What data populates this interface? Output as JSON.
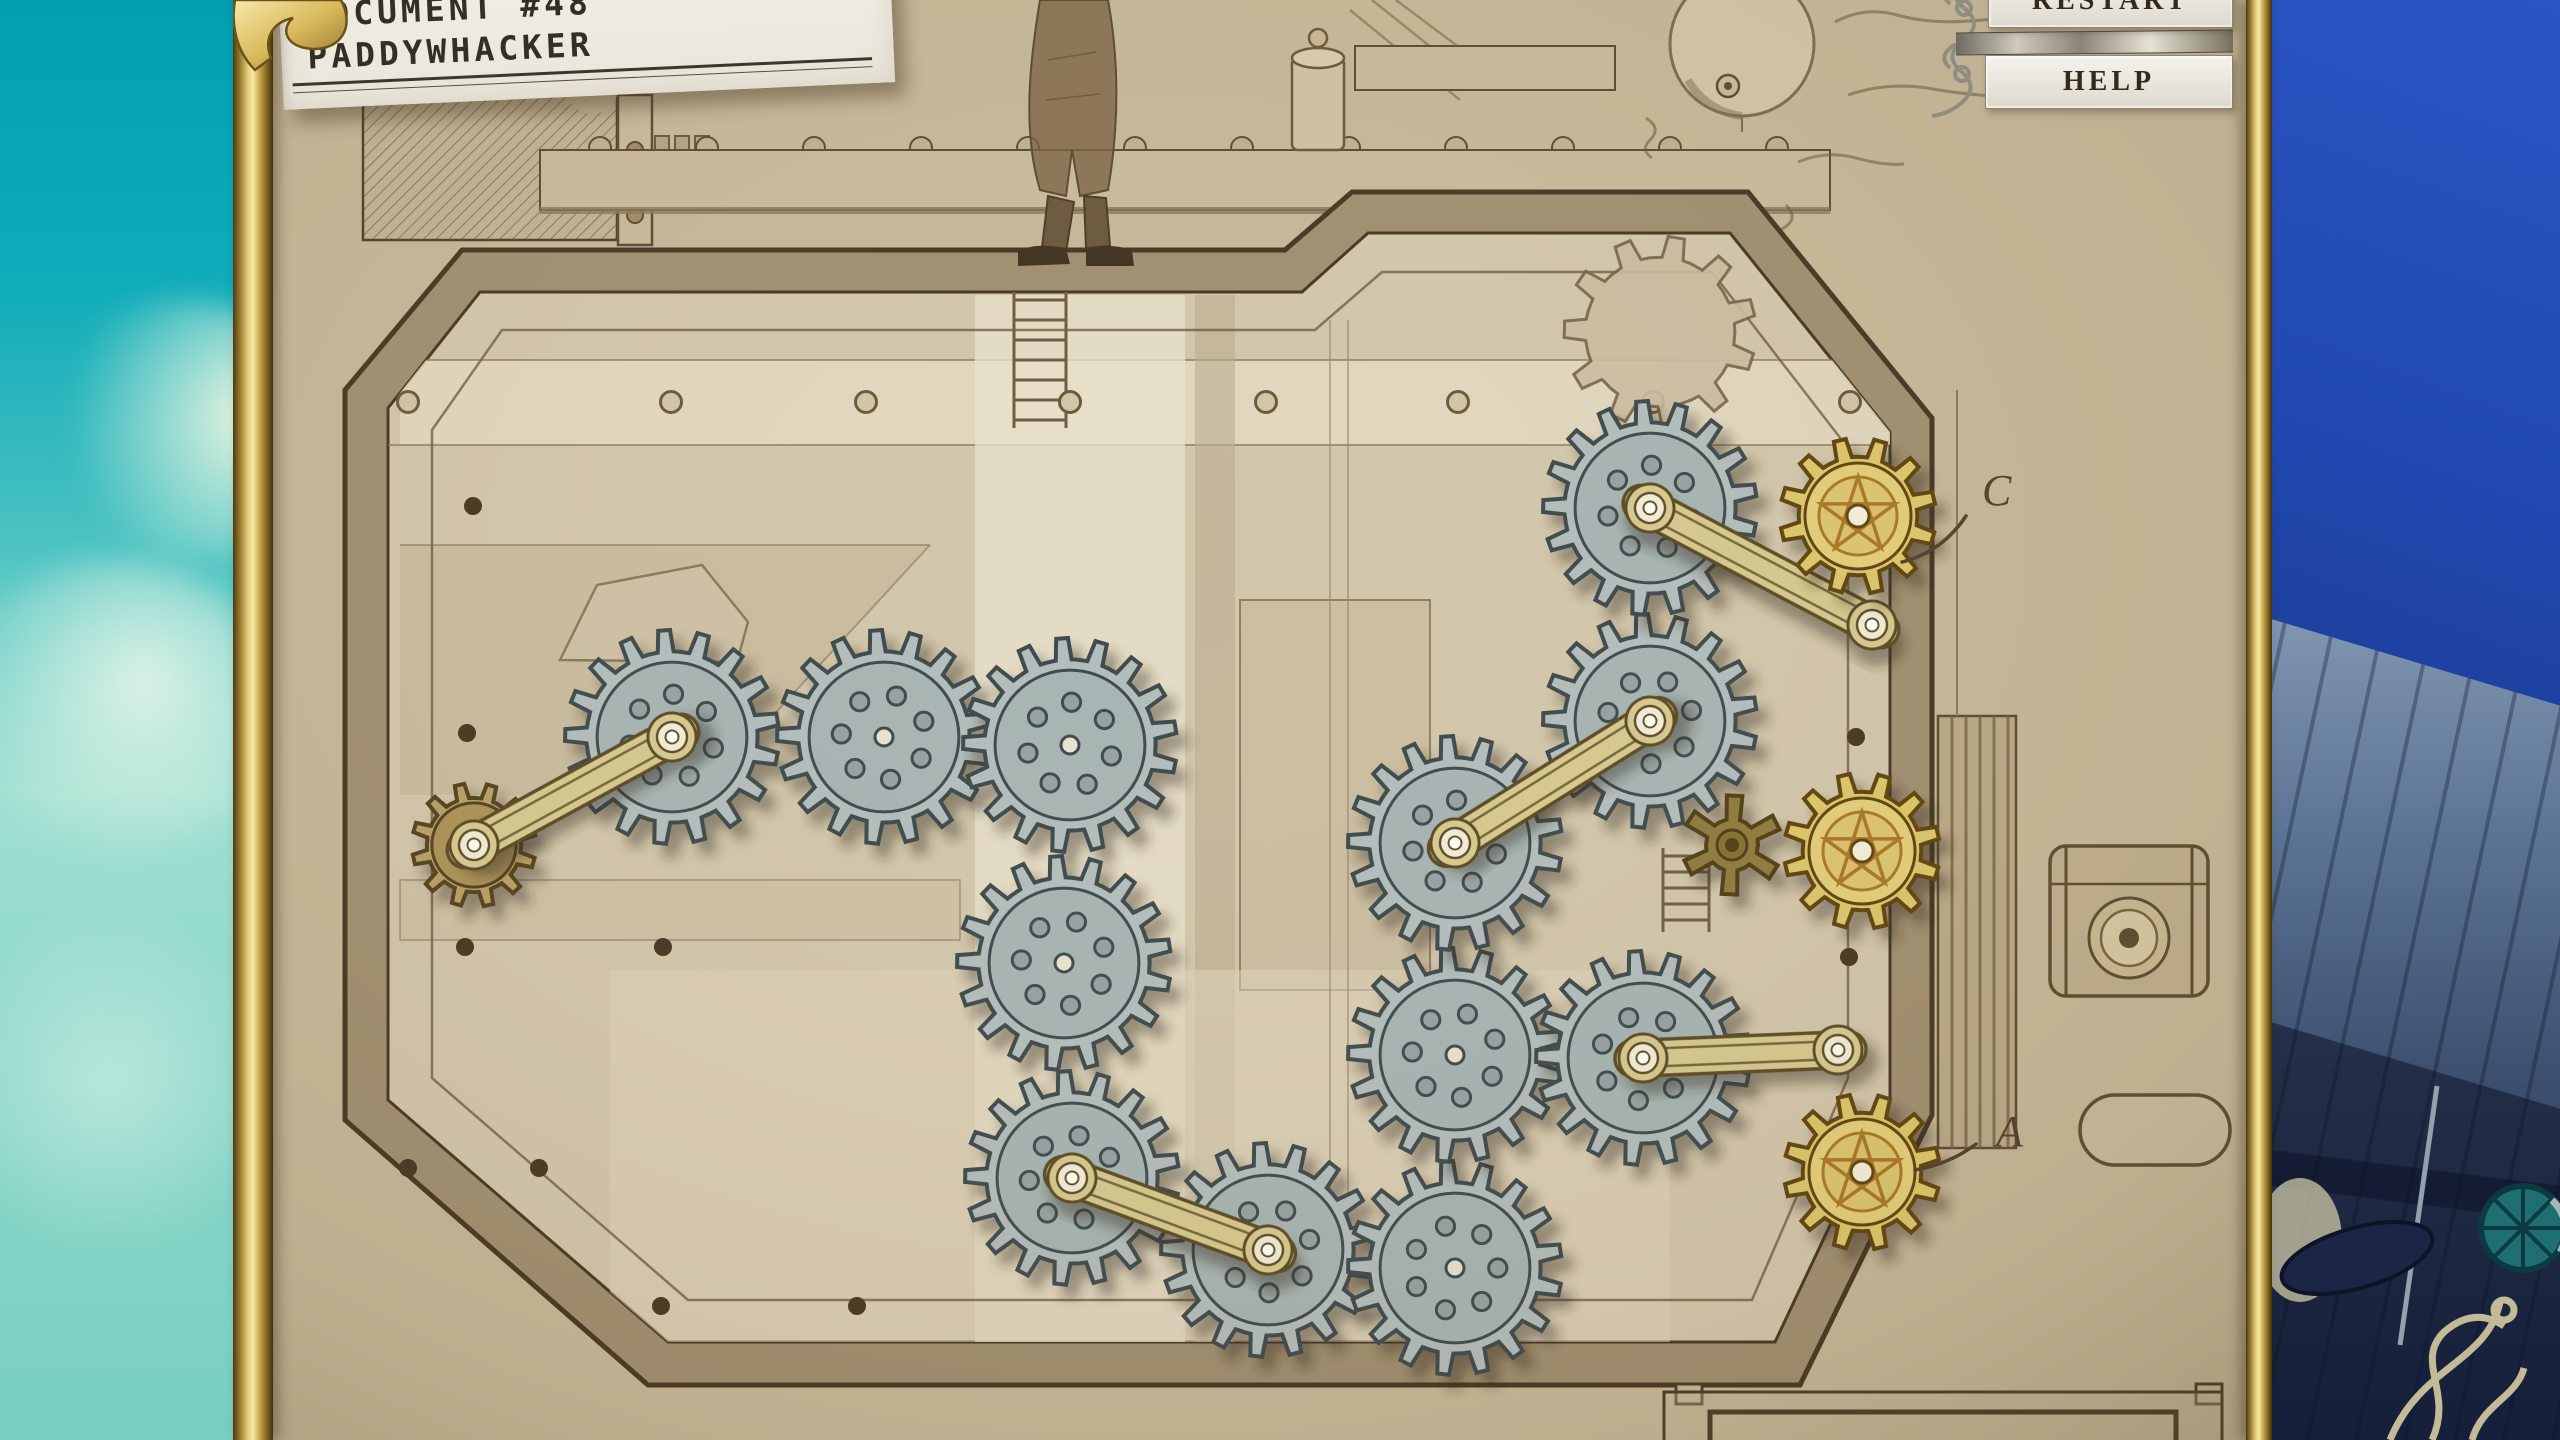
{
  "document": {
    "line1": "DOCUMENT #48",
    "line2": "PADDYWHACKER"
  },
  "buttons": {
    "restart": "RESTART",
    "help": "HELP"
  },
  "colors": {
    "parchment": "#c6b798",
    "board_face": "#d2c6ab",
    "board_rim": "#a08e70",
    "outline": "#443622",
    "blue_gear": "#b2bdbc",
    "blue_gear_disc": "#a6b4b3",
    "blue_gear_line": "#3d484b",
    "gold_gear": "#dcc76a",
    "gold_gear_disc": "#e3cf78",
    "gold_gear_line": "#5f430f",
    "gold_star_line": "#a87628",
    "brown_gear": "#b7a065",
    "brown_gear_line": "#53401f",
    "star_gear": "#8f7a3d",
    "star_gear_line": "#4f3d15",
    "rod": "#d6c98e",
    "rod_line": "#5a4a22",
    "hub": "#f2ecd9",
    "ink": "#4f3f2c",
    "sky_top": "#009fb2",
    "ship_blue": "#1e42a6",
    "gold_frame": "#c9a84e",
    "button_bg": "#ece9e2",
    "button_text": "#342a1c"
  },
  "puzzle": {
    "gears": [
      {
        "id": "sketched-gear",
        "kind": "sketch",
        "cx": 1660,
        "cy": 332,
        "r": 96,
        "teeth": 11
      },
      {
        "id": "small-brown-gear",
        "kind": "brown",
        "cx": 474,
        "cy": 845,
        "r": 62,
        "teeth": 12
      },
      {
        "id": "blue-gear-1",
        "kind": "blue",
        "cx": 672,
        "cy": 737,
        "r": 107,
        "teeth": 17
      },
      {
        "id": "blue-gear-2",
        "kind": "blue",
        "cx": 884,
        "cy": 737,
        "r": 107,
        "teeth": 17
      },
      {
        "id": "blue-gear-3",
        "kind": "blue",
        "cx": 1070,
        "cy": 745,
        "r": 107,
        "teeth": 17
      },
      {
        "id": "blue-gear-4",
        "kind": "blue",
        "cx": 1064,
        "cy": 963,
        "r": 107,
        "teeth": 17
      },
      {
        "id": "blue-gear-5",
        "kind": "blue",
        "cx": 1072,
        "cy": 1178,
        "r": 107,
        "teeth": 17
      },
      {
        "id": "blue-gear-6",
        "kind": "blue",
        "cx": 1268,
        "cy": 1250,
        "r": 107,
        "teeth": 17
      },
      {
        "id": "blue-gear-7",
        "kind": "blue",
        "cx": 1455,
        "cy": 1268,
        "r": 107,
        "teeth": 17
      },
      {
        "id": "blue-gear-8",
        "kind": "blue",
        "cx": 1455,
        "cy": 1055,
        "r": 107,
        "teeth": 17
      },
      {
        "id": "blue-gear-9",
        "kind": "blue",
        "cx": 1455,
        "cy": 843,
        "r": 107,
        "teeth": 17
      },
      {
        "id": "blue-gear-10",
        "kind": "blue",
        "cx": 1650,
        "cy": 721,
        "r": 107,
        "teeth": 17
      },
      {
        "id": "blue-gear-11",
        "kind": "blue",
        "cx": 1650,
        "cy": 508,
        "r": 107,
        "teeth": 17
      },
      {
        "id": "blue-gear-12",
        "kind": "blue",
        "cx": 1643,
        "cy": 1058,
        "r": 107,
        "teeth": 17
      },
      {
        "id": "star-gear",
        "kind": "star",
        "cx": 1732,
        "cy": 845,
        "r": 50,
        "teeth": 6
      },
      {
        "id": "gold-gear-c",
        "kind": "gold",
        "cx": 1858,
        "cy": 516,
        "r": 78,
        "teeth": 12
      },
      {
        "id": "gold-gear-mid",
        "kind": "gold",
        "cx": 1862,
        "cy": 851,
        "r": 78,
        "teeth": 12
      },
      {
        "id": "gold-gear-a",
        "kind": "gold",
        "cx": 1862,
        "cy": 1172,
        "r": 78,
        "teeth": 12
      }
    ],
    "rods": [
      {
        "id": "rod-1",
        "from": [
          474,
          845
        ],
        "to": [
          672,
          737
        ]
      },
      {
        "id": "rod-2",
        "from": [
          1455,
          843
        ],
        "to": [
          1650,
          721
        ]
      },
      {
        "id": "rod-3",
        "from": [
          1650,
          508
        ],
        "to": [
          1872,
          625
        ]
      },
      {
        "id": "rod-4",
        "from": [
          1643,
          1058
        ],
        "to": [
          1838,
          1050
        ]
      },
      {
        "id": "rod-5",
        "from": [
          1072,
          1178
        ],
        "to": [
          1268,
          1250
        ]
      }
    ],
    "labels": [
      {
        "id": "gear-label-c",
        "text": "C",
        "x": 1982,
        "y": 505,
        "curve": "M1902,562 Q1942,552 1966,516"
      },
      {
        "id": "gear-label-a",
        "text": "A",
        "x": 1996,
        "y": 1146,
        "curve": "M1915,1170 Q1950,1164 1976,1144"
      }
    ]
  }
}
